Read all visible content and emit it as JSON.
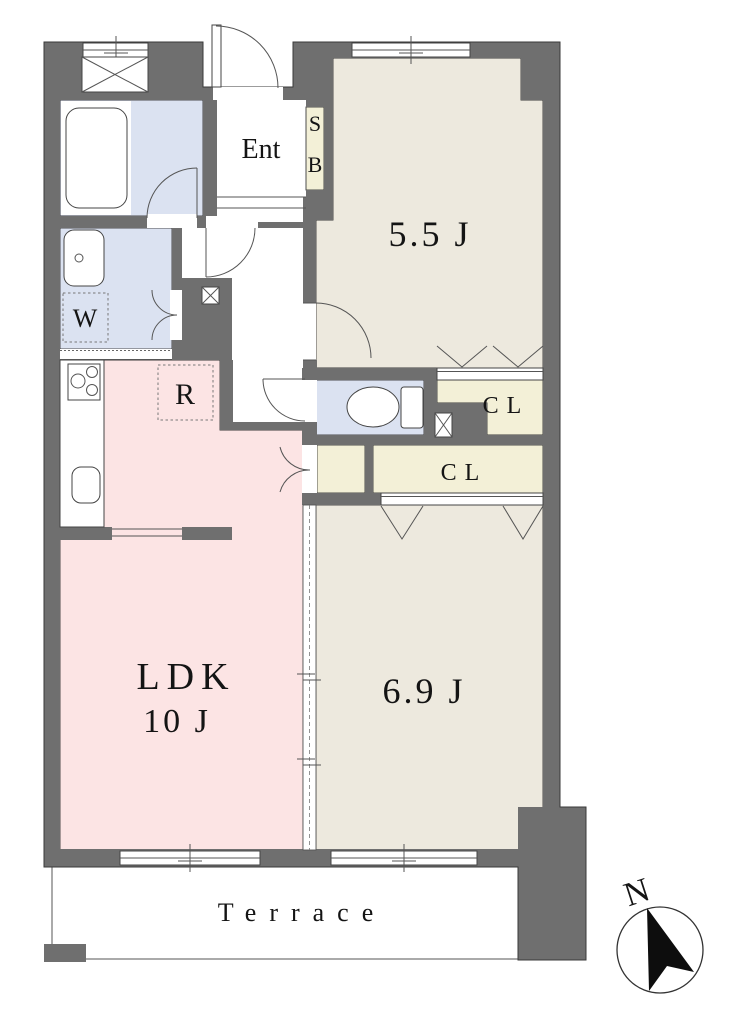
{
  "floorplan": {
    "labels": {
      "entrance": "Ent",
      "shoe_box_line1": "S",
      "shoe_box_line2": "B",
      "bedroom_north": "5.5 J",
      "washer": "W",
      "refrigerator": "R",
      "closet_upper": "CL",
      "closet_lower": "CL",
      "living": "LDK",
      "living_size": "10 J",
      "bedroom_south": "6.9 J",
      "terrace": "Terrace",
      "compass_north": "N"
    },
    "colors": {
      "wall": "#6f6f6f",
      "tatami": "#ede9de",
      "ldk": "#fce4e4",
      "wet": "#dbe2f1",
      "closet": "#f3f0d7"
    }
  }
}
